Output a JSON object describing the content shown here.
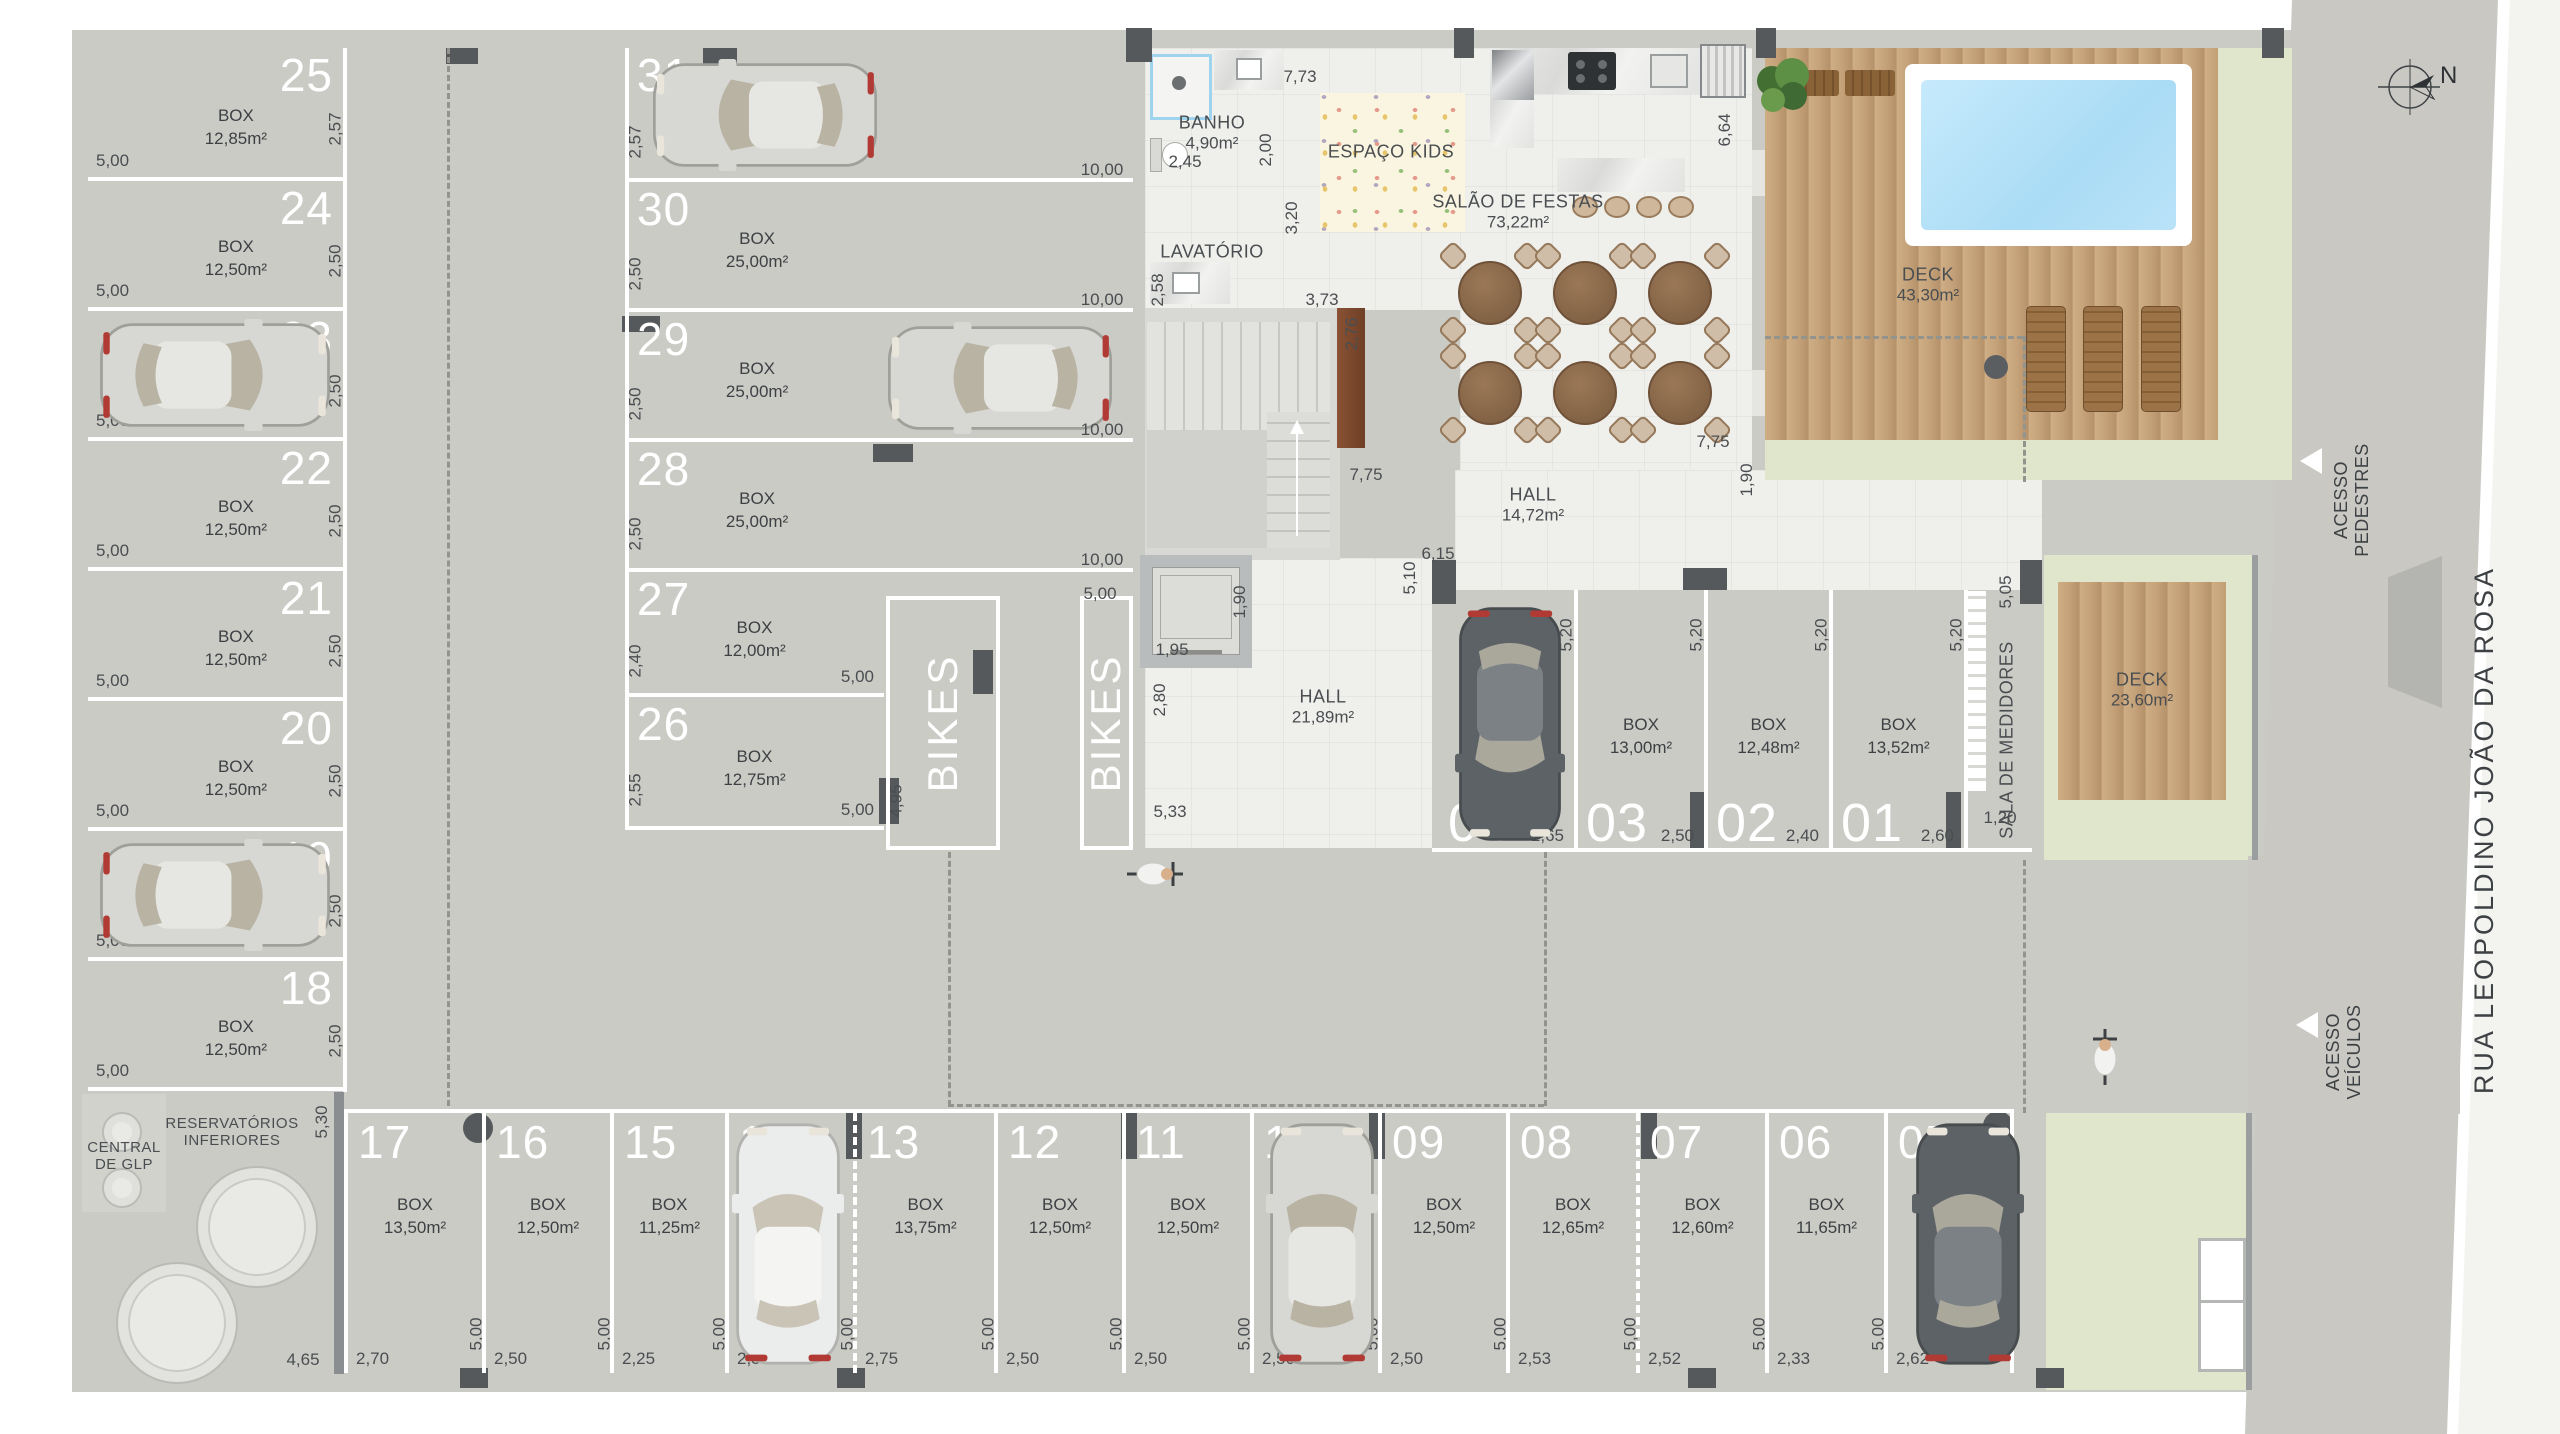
{
  "box_label": "BOX",
  "street_label": "RUA LEOPOLDINO JOÃO DA ROSA",
  "compass_label": "N",
  "access_pedestrians_line1": "ACESSO",
  "access_pedestrians_line2": "PEDESTRES",
  "access_vehicles_line1": "ACESSO",
  "access_vehicles_line2": "VEÍCULOS",
  "bikes_label": "BIKES",
  "colors": {
    "wall": "#73777a",
    "floor_concrete": "#cbcbc6",
    "floor_white": "#efefec",
    "pool_water": "#b9e2f8",
    "lawn": "#dfe6cb",
    "deck_wood": "#c5a077",
    "marking": "#ffffff"
  },
  "rooms": {
    "banho": {
      "name": "BANHO",
      "area": "4,90m²"
    },
    "lavatorio": {
      "name": "LAVATÓRIO"
    },
    "espaco_kids": {
      "name": "ESPAÇO KIDS"
    },
    "salao": {
      "name": "SALÃO DE FESTAS",
      "area": "73,22m²"
    },
    "hall_upper": {
      "name": "HALL",
      "area": "14,72m²"
    },
    "hall_lower": {
      "name": "HALL",
      "area": "21,89m²"
    },
    "deck_pool": {
      "name": "DECK",
      "area": "43,30m²"
    },
    "deck_lawn": {
      "name": "DECK",
      "area": "23,60m²"
    },
    "sala_medidores": {
      "name": "SALA DE MEDIDORES"
    },
    "central_glp": {
      "name": "CENTRAL",
      "name2": "DE GLP"
    },
    "reservatorios": {
      "name": "RESERVATÓRIOS",
      "name2": "INFERIORES"
    }
  },
  "spots": {
    "left_column": [
      {
        "num": "25",
        "area": "12,85m²",
        "width": "5,00",
        "depth": "2,57"
      },
      {
        "num": "24",
        "area": "12,50m²",
        "width": "5,00",
        "depth": "2,50"
      },
      {
        "num": "23",
        "area": "12,50m²",
        "width": "5,00",
        "depth": "2,50",
        "car": "silver"
      },
      {
        "num": "22",
        "area": "12,50m²",
        "width": "5,00",
        "depth": "2,50"
      },
      {
        "num": "21",
        "area": "12,50m²",
        "width": "5,00",
        "depth": "2,50"
      },
      {
        "num": "20",
        "area": "12,50m²",
        "width": "5,00",
        "depth": "2,50"
      },
      {
        "num": "19",
        "area": "12,50m²",
        "width": "5,00",
        "depth": "2,50",
        "car": "silver"
      },
      {
        "num": "18",
        "area": "12,50m²",
        "width": "5,00",
        "depth": "2,50"
      }
    ],
    "mid_column": [
      {
        "num": "31",
        "area": "25,70m²",
        "length": "10,00",
        "depth": "2,57",
        "car": "silver"
      },
      {
        "num": "30",
        "area": "25,00m²",
        "length": "10,00",
        "depth": "2,50"
      },
      {
        "num": "29",
        "area": "25,00m²",
        "length": "10,00",
        "depth": "2,50",
        "car": "silver"
      },
      {
        "num": "28",
        "area": "25,00m²",
        "length": "10,00",
        "depth": "2,50"
      },
      {
        "num": "27",
        "area": "12,00m²",
        "length": "5,00",
        "depth": "2,40"
      },
      {
        "num": "26",
        "area": "12,75m²",
        "length": "5,00",
        "depth": "2,55"
      }
    ],
    "inner_row": [
      {
        "num": "04",
        "area": "13,78m²",
        "width": "2,65",
        "length": "5,20",
        "car": "dark"
      },
      {
        "num": "03",
        "area": "13,00m²",
        "width": "2,50",
        "length": "5,20"
      },
      {
        "num": "02",
        "area": "12,48m²",
        "width": "2,40",
        "length": "5,20"
      },
      {
        "num": "01",
        "area": "13,52m²",
        "width": "2,60",
        "length": "5,20"
      }
    ],
    "bottom_row": [
      {
        "num": "17",
        "area": "13,50m²",
        "width": "2,70",
        "length": "5,00"
      },
      {
        "num": "16",
        "area": "12,50m²",
        "width": "2,50",
        "length": "5,00"
      },
      {
        "num": "15",
        "area": "11,25m²",
        "width": "2,25",
        "length": "5,00"
      },
      {
        "num": "14",
        "area": "12,50m²",
        "width": "2,50",
        "length": "5,00",
        "car": "white"
      },
      {
        "num": "13",
        "area": "13,75m²",
        "width": "2,75",
        "length": "5,00"
      },
      {
        "num": "12",
        "area": "12,50m²",
        "width": "2,50",
        "length": "5,00"
      },
      {
        "num": "11",
        "area": "12,50m²",
        "width": "2,50",
        "length": "5,00"
      },
      {
        "num": "10",
        "area": "12,50m²",
        "width": "2,50",
        "length": "5,00",
        "car": "silver"
      },
      {
        "num": "09",
        "area": "12,50m²",
        "width": "2,50",
        "length": "5,00"
      },
      {
        "num": "08",
        "area": "12,65m²",
        "width": "2,53",
        "length": "5,00"
      },
      {
        "num": "07",
        "area": "12,60m²",
        "width": "2,52",
        "length": "5,00"
      },
      {
        "num": "06",
        "area": "11,65m²",
        "width": "2,33",
        "length": "5,00"
      },
      {
        "num": "05",
        "area": "13,10m²",
        "width": "2,62",
        "length": "5,00",
        "car": "dark"
      }
    ]
  },
  "bike_dims": {
    "left_zone": "4,95",
    "right_zone": "5,00"
  },
  "loose_dims": [
    {
      "id": "d773",
      "text": "7,73"
    },
    {
      "id": "d245",
      "text": "2,45"
    },
    {
      "id": "d200",
      "text": "2,00",
      "rot": true
    },
    {
      "id": "d320",
      "text": "3,20",
      "rot": true
    },
    {
      "id": "d258",
      "text": "2,58",
      "rot": true
    },
    {
      "id": "d373",
      "text": "3,73"
    },
    {
      "id": "d276",
      "text": "2,76",
      "rot": true
    },
    {
      "id": "d775a",
      "text": "7,75"
    },
    {
      "id": "d664",
      "text": "6,64",
      "rot": true
    },
    {
      "id": "d775b",
      "text": "7,75"
    },
    {
      "id": "d190a",
      "text": "1,90",
      "rot": true
    },
    {
      "id": "d615",
      "text": "6,15"
    },
    {
      "id": "d510",
      "text": "5,10",
      "rot": true
    },
    {
      "id": "d195",
      "text": "1,95"
    },
    {
      "id": "d190b",
      "text": "1,90",
      "rot": true
    },
    {
      "id": "d280",
      "text": "2,80",
      "rot": true
    },
    {
      "id": "d533",
      "text": "5,33"
    },
    {
      "id": "d1000a",
      "text": "10,00"
    },
    {
      "id": "d1000b",
      "text": "10,00"
    },
    {
      "id": "d1000c",
      "text": "10,00"
    },
    {
      "id": "d1000d",
      "text": "10,00"
    },
    {
      "id": "d505",
      "text": "5,05",
      "rot": true
    },
    {
      "id": "d120",
      "text": "1,20"
    },
    {
      "id": "d530",
      "text": "5,30",
      "rot": true
    },
    {
      "id": "d465",
      "text": "4,65"
    }
  ]
}
